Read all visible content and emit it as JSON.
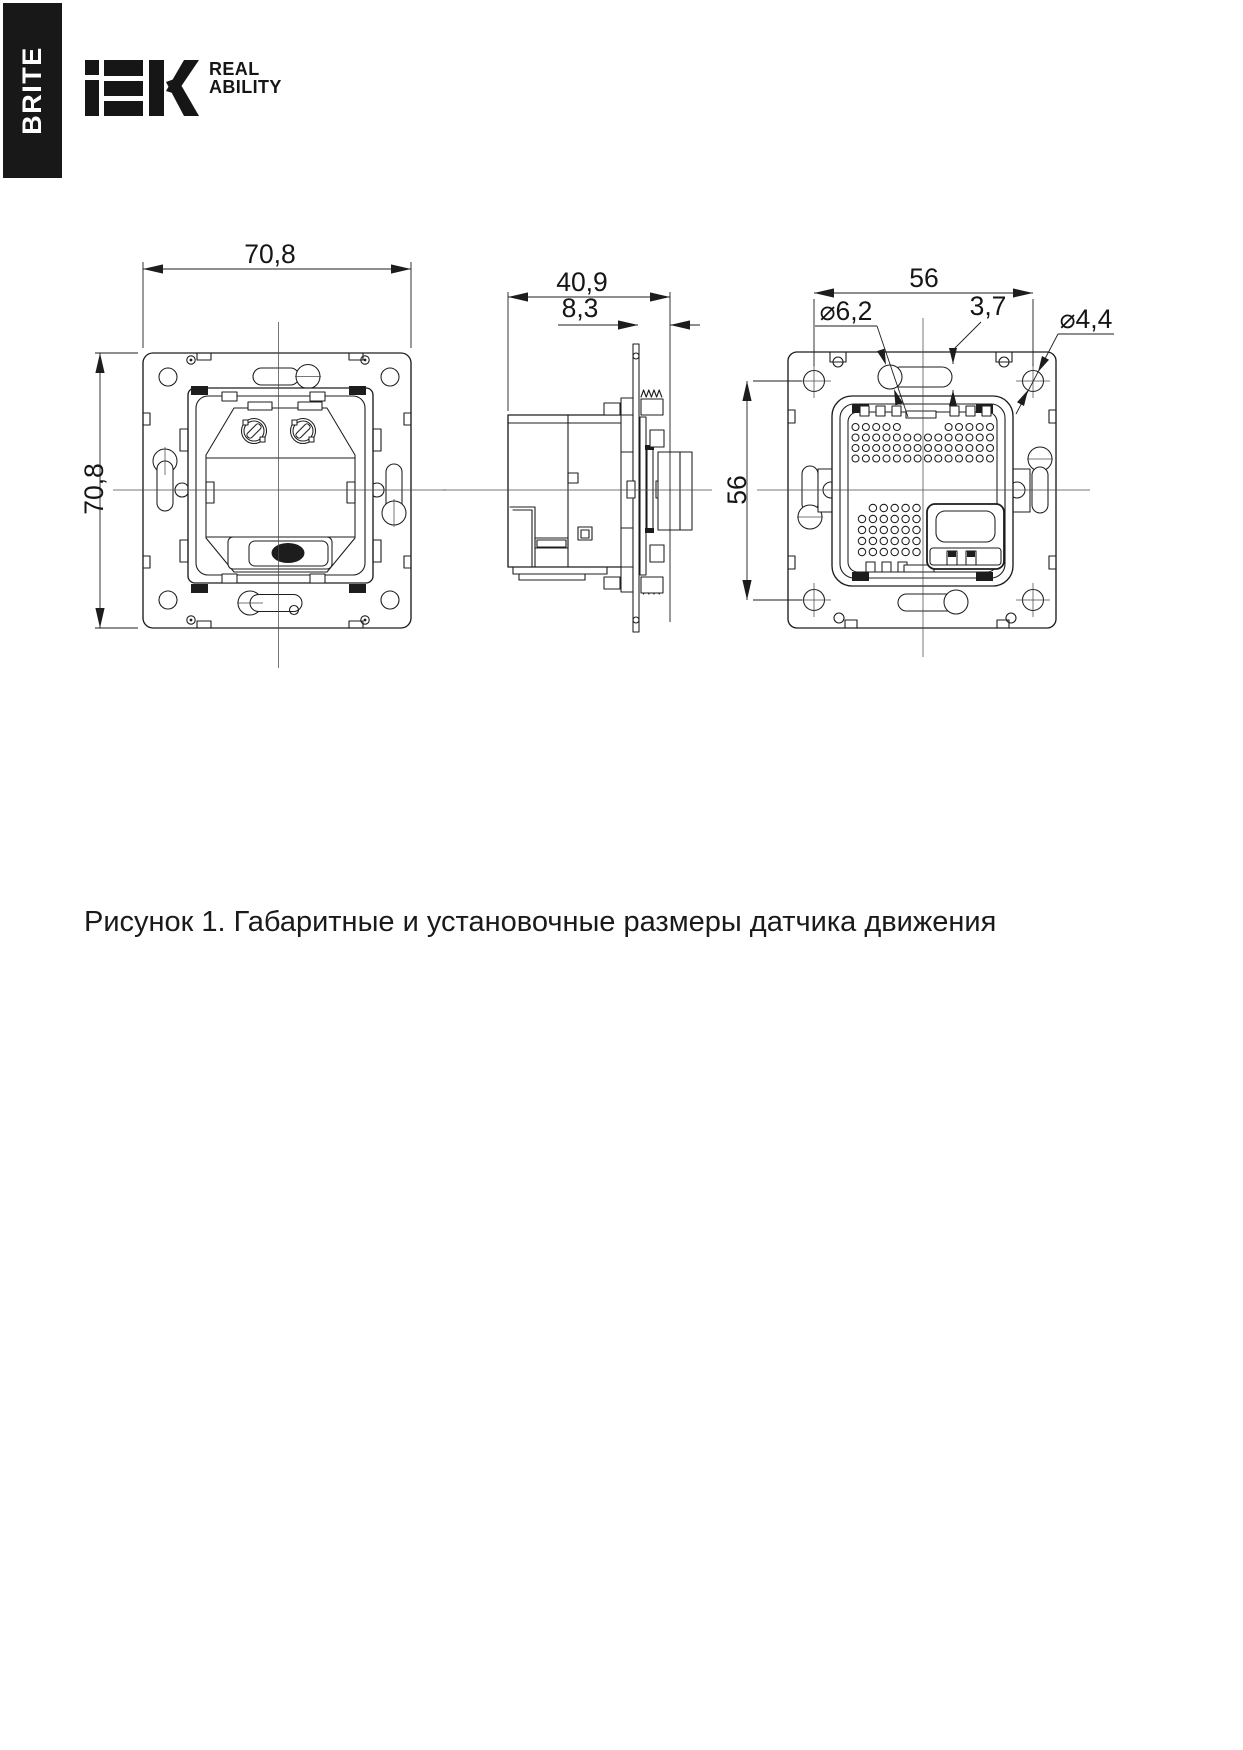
{
  "brand": {
    "series": "BRITE",
    "logo": "IEK",
    "tagline_line1": "REAL",
    "tagline_line2": "ABILITY"
  },
  "figure": {
    "caption": "Рисунок 1. Габаритные и установочные размеры датчика движения",
    "views": {
      "front": {
        "width_mm": "70,8",
        "height_mm": "70,8"
      },
      "side": {
        "depth_mm": "40,9",
        "plate_offset_mm": "8,3"
      },
      "rear": {
        "width_mm": "56",
        "height_mm": "56",
        "keyhole_diameter": "⌀6,2",
        "slot_width_mm": "3,7",
        "hole_diameter": "⌀4,4"
      }
    }
  }
}
